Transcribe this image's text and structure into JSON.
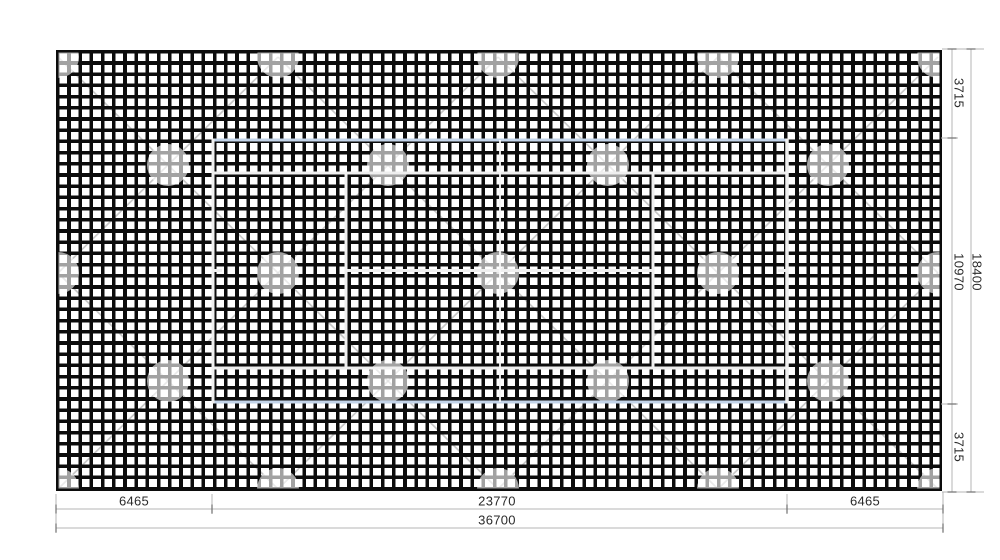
{
  "drawing_type": "site-plan",
  "dimensions": {
    "bottom_left": "6465",
    "bottom_center": "23770",
    "bottom_right": "6465",
    "bottom_total": "36700",
    "right_top": "3715",
    "right_middle": "10970",
    "right_bottom": "3715",
    "right_total": "18400"
  },
  "colors": {
    "grid": "#0c0c0c",
    "court_line": "#efefef",
    "court_boundary": "#c3d4e9",
    "dimension_line": "#b5b5b5",
    "dimension_tick": "#6f6f6f",
    "dimension_text": "#2b2b2b",
    "lattice_line": "#9b9b9b"
  }
}
